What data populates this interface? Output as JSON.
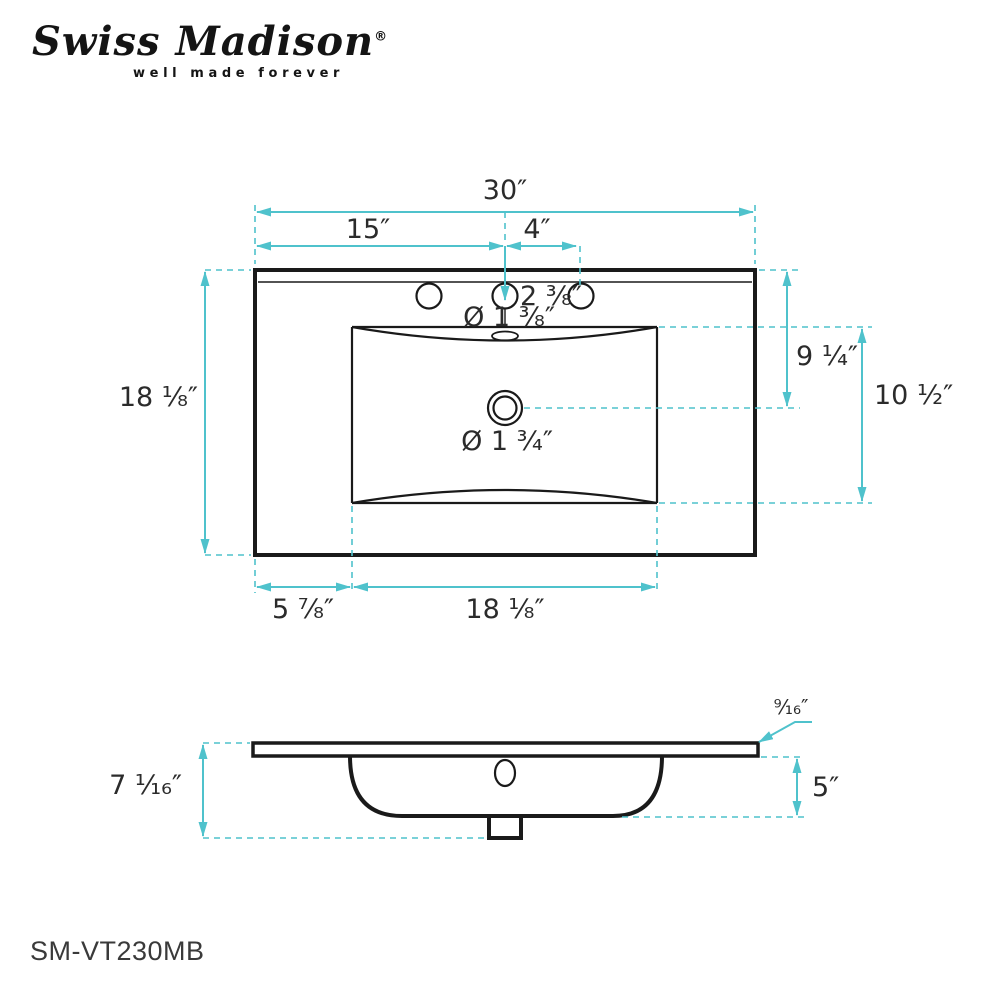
{
  "brand": {
    "name": "Swiss Madison",
    "registered": "®",
    "tagline": "well made forever"
  },
  "part_number": "SM-VT230MB",
  "colors": {
    "dimension_teal": "#4fc2cc",
    "drawing_black": "#1a1a1a",
    "text_black": "#2b2b2b"
  },
  "top_view": {
    "dim_overall_width": "30″",
    "dim_left_to_center": "15″",
    "dim_center_to_side_hole": "4″",
    "dim_hole_setback": "2 ³⁄₈″",
    "dim_faucet_hole_diameter": "Ø 1 ³⁄₈″",
    "dim_drain_diameter": "Ø 1 ³⁄₄″",
    "dim_overall_depth": "18 ¹⁄₈″",
    "dim_top_to_drain": "9 ¹⁄₄″",
    "dim_basin_front_to_back": "10 ¹⁄₂″",
    "dim_left_edge_to_basin": "5 ⁷⁄₈″",
    "dim_basin_width": "18 ¹⁄₈″"
  },
  "side_view": {
    "dim_top_thickness": "⁹⁄₁₆″",
    "dim_overall_height": "7 ¹⁄₁₆″",
    "dim_basin_depth": "5″"
  }
}
